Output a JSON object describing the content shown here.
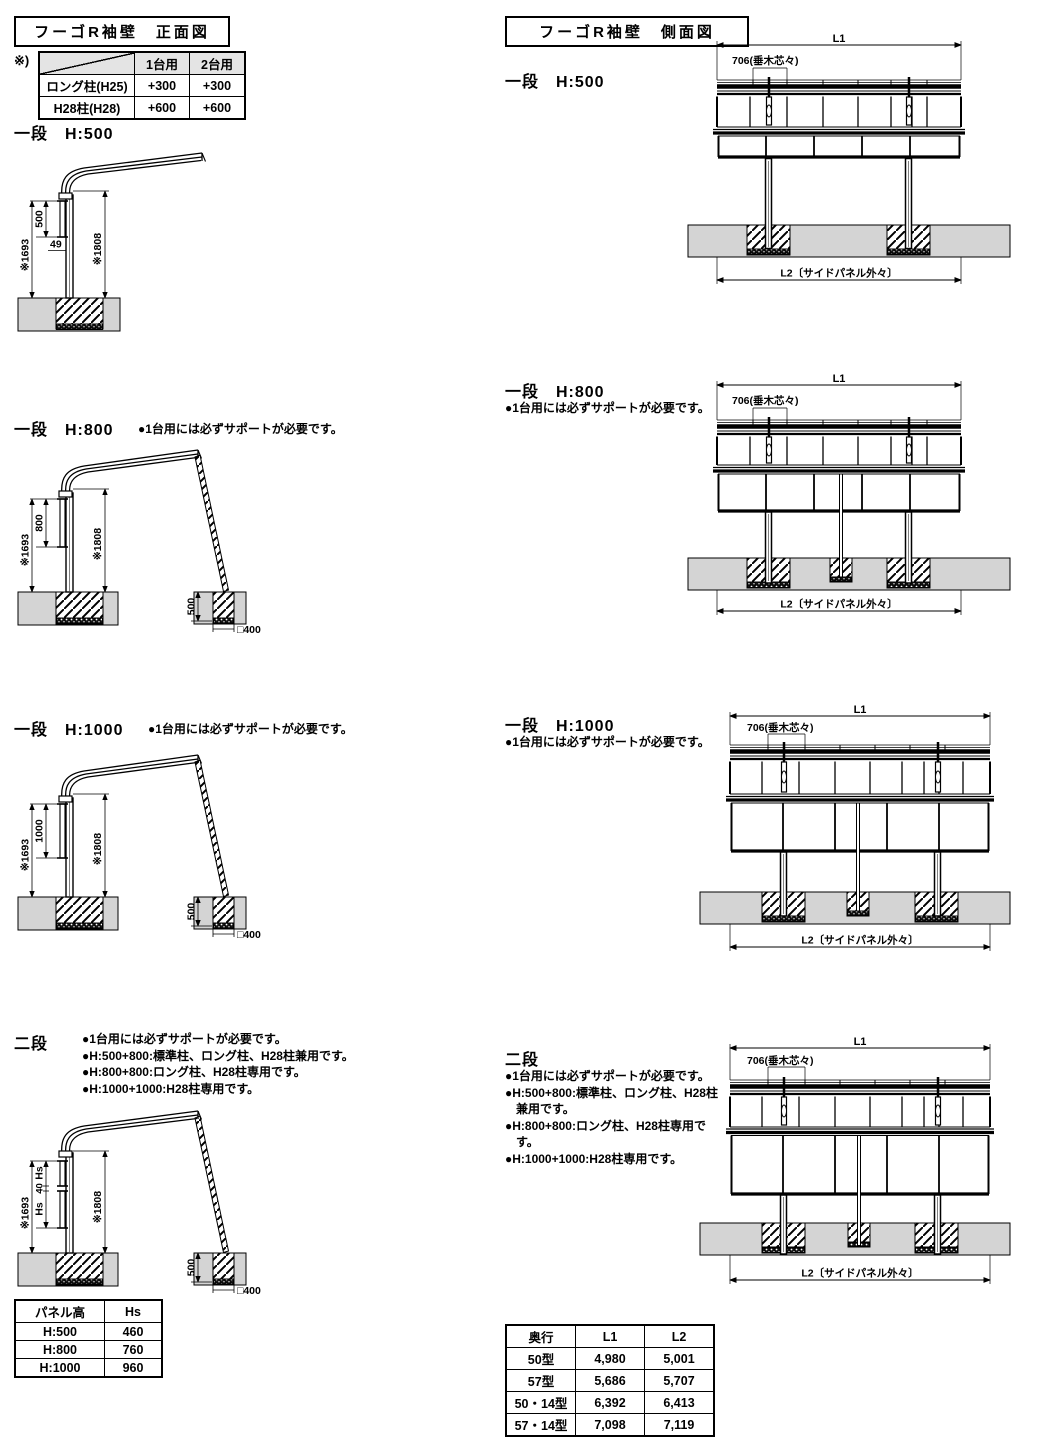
{
  "colors": {
    "ground": "#d4d4d4",
    "line": "#000000",
    "header_bg": "#e4e4e4"
  },
  "front": {
    "title": "フーゴR袖壁　正面図",
    "note_mark": "※)",
    "spec_table": {
      "c1": "1台用",
      "c2": "2台用",
      "r1": "ロング柱(H25)",
      "r1v1": "+300",
      "r1v2": "+300",
      "r2": "H28柱(H28)",
      "r2v1": "+600",
      "r2v2": "+600"
    },
    "s500": {
      "heading": "一段　H:500",
      "dim_left": "※1693",
      "dim_panel": "500",
      "dim_49": "49",
      "dim_right": "※1808"
    },
    "s800": {
      "heading": "一段　H:800",
      "note": "●1台用には必ずサポートが必要です。",
      "dim_left": "※1693",
      "dim_panel": "800",
      "dim_right": "※1808",
      "dim_depth": "500",
      "dim_footing": "□400"
    },
    "s1000": {
      "heading": "一段　H:1000",
      "note": "●1台用には必ずサポートが必要です。",
      "dim_left": "※1693",
      "dim_panel": "1000",
      "dim_right": "※1808",
      "dim_depth": "500",
      "dim_footing": "□400"
    },
    "s2dan": {
      "heading": "二段",
      "note1": "●1台用には必ずサポートが必要です。",
      "note2": "●H:500+800:標準柱、ロング柱、H28柱兼用です。",
      "note3": "●H:800+800:ロング柱、H28柱専用です。",
      "note4": "●H:1000+1000:H28柱専用です。",
      "dim_left": "※1693",
      "dim_hs1": "Hs",
      "dim_40": "40",
      "dim_hs2": "Hs",
      "dim_right": "※1808",
      "dim_depth": "500",
      "dim_footing": "□400"
    },
    "panel_table": {
      "h1": "パネル高",
      "h2": "Hs",
      "rows": [
        [
          "H:500",
          "460"
        ],
        [
          "H:800",
          "760"
        ],
        [
          "H:1000",
          "960"
        ]
      ]
    }
  },
  "side": {
    "title": "フーゴR袖壁　側面図",
    "dim_l1": "L1",
    "dim_rafter": "706(垂木芯々)",
    "dim_l2": "L2〔サイドパネル外々〕",
    "s500": {
      "heading": "一段　H:500"
    },
    "s800": {
      "heading": "一段　H:800",
      "note": "●1台用には必ずサポートが必要です。"
    },
    "s1000": {
      "heading": "一段　H:1000",
      "note": "●1台用には必ずサポートが必要です。"
    },
    "s2dan": {
      "heading": "二段",
      "note1": "●1台用には必ずサポートが必要です。",
      "note2": "●H:500+800:標準柱、ロング柱、H28柱兼用です。",
      "note3": "●H:800+800:ロング柱、H28柱専用です。",
      "note4": "●H:1000+1000:H28柱専用です。"
    },
    "depth_table": {
      "h1": "奥行",
      "h2": "L1",
      "h3": "L2",
      "rows": [
        [
          "50型",
          "4,980",
          "5,001"
        ],
        [
          "57型",
          "5,686",
          "5,707"
        ],
        [
          "50・14型",
          "6,392",
          "6,413"
        ],
        [
          "57・14型",
          "7,098",
          "7,119"
        ]
      ]
    }
  }
}
